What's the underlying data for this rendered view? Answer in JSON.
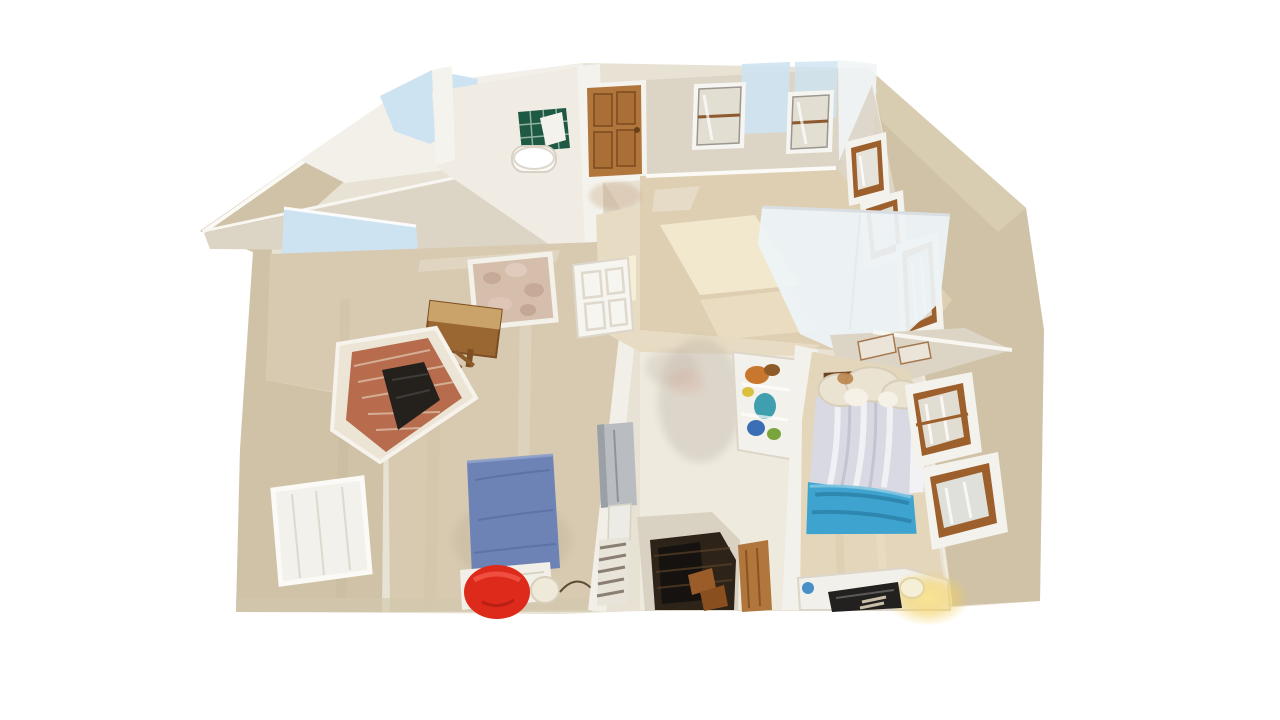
{
  "app": {
    "type": "3d-dollhouse-view",
    "description": "Top-down 3D dollhouse scan of an upper floor: bathroom with green tiled tub and pedestal sink, empty top bedroom with wooden door and windows, left living area with brick fireplace, blue floor mattress and red beanbag, right bedroom with made bed, lit desk lamp, and a central stairwell with cabinet and toy shelf"
  },
  "palette": {
    "background": "#ffffff",
    "exterior_wall": "#cfc2a6",
    "exterior_wall_light": "#dbd0b7",
    "interior_wall": "#e8e2d5",
    "wall_top": "#f6f4ee",
    "ceiling": "#f3f0e9",
    "band_greige": "#dcd5c6",
    "bathroom_floor": "#f0ece3",
    "carpet_main": "#decfb3",
    "carpet_left": "#d8cab0",
    "carpet_hall": "#e7dcc3",
    "corridor_floor": "#eeeade",
    "skylight_blue": "#cde3f2",
    "pale_plane": "#edf3f6",
    "tile_green": "#1e5a43",
    "door_wood": "#b0763c",
    "white_door": "#f7f5f0",
    "brick": "#b76c4e",
    "brick_mortar": "#e9d8c5",
    "fireplace_insert": "#24211d",
    "mattress_blue": "#6d83b5",
    "sheet_white": "#f1efe8",
    "beanbag_red": "#dd2a1b",
    "comforter_gray": "#d9d9e4",
    "blanket_blue": "#3fa3cf",
    "fur_cream": "#ebe3d2",
    "stairs_dark": "#2e2318",
    "stair_wood": "#9a5c28",
    "cabinet_gray": "#b9bdc2",
    "zebra_base": "#e9e4da",
    "lamp_glow": "#f7dd7e",
    "desk_white": "#f2f0ea",
    "laptop_dark": "#23211f",
    "window_wood": "#9d5f2c",
    "window_pane": "#e2ded2",
    "curtain_white": "#f3f1ec",
    "rug_mottled": "#d5beac",
    "shelf_white": "#f3f1ec"
  },
  "scene": {
    "rooms": [
      {
        "name": "bathroom",
        "features": [
          "green-tiled-tub",
          "pedestal-sink"
        ]
      },
      {
        "name": "bedroom-top-right",
        "features": [
          "wooden-door",
          "two-top-windows",
          "bare-carpet",
          "light-planes"
        ]
      },
      {
        "name": "living-area-left",
        "features": [
          "brick-fireplace",
          "blue-floor-mattress",
          "red-beanbag",
          "wood-desk",
          "curtained-window",
          "skylight-planes"
        ]
      },
      {
        "name": "bedroom-bottom-right",
        "features": [
          "bed-with-gray-comforter",
          "blue-blanket",
          "fur-pillows",
          "side-windows",
          "desk-with-laptop",
          "lit-lamp"
        ]
      },
      {
        "name": "stairwell-hall",
        "features": [
          "dark-staircase",
          "gray-cabinet",
          "zebra-print-bin",
          "toy-shelf",
          "scan-blur"
        ]
      }
    ],
    "artifacts": [
      "skylight-blue-planes",
      "scan-blur-smudge",
      "white-light-planes"
    ]
  }
}
